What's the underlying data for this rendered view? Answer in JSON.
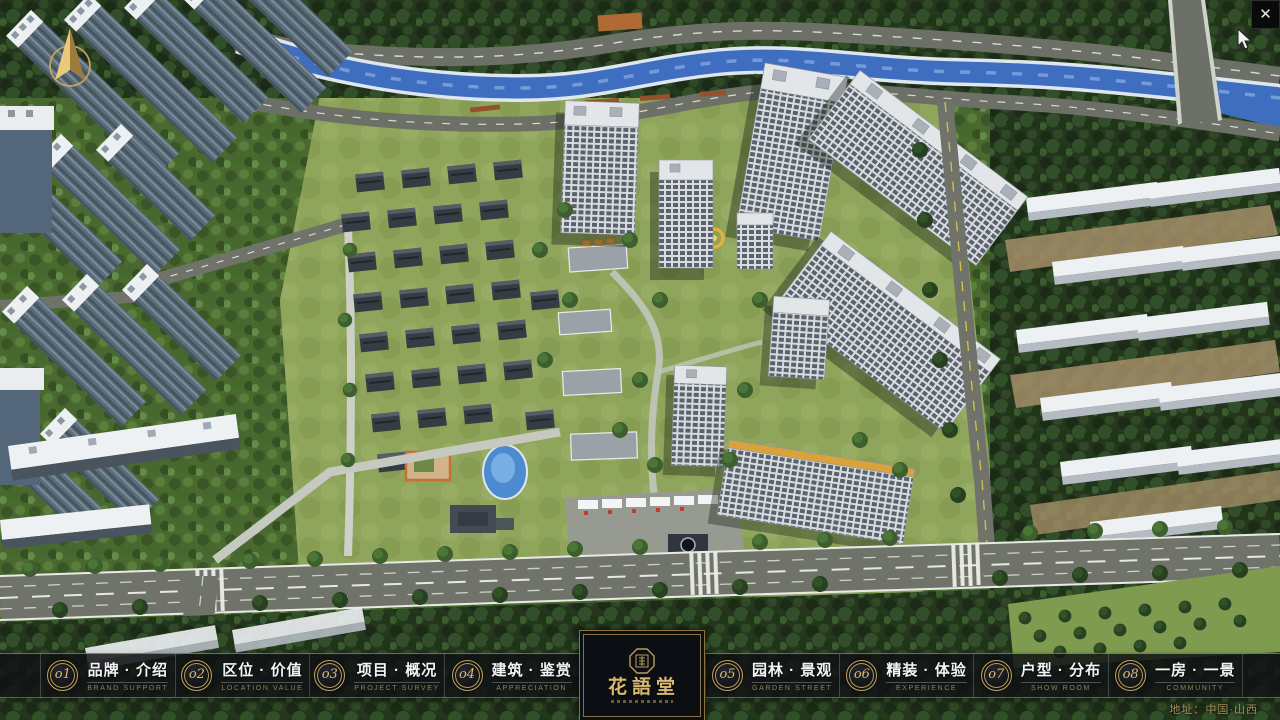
{
  "nav": {
    "items": [
      {
        "num": "o1",
        "label": "品牌 · 介绍",
        "sublabel": "BRAND SUPPORT"
      },
      {
        "num": "o2",
        "label": "区位 · 价值",
        "sublabel": "LOCATION VALUE"
      },
      {
        "num": "o3",
        "label": "项目 · 概况",
        "sublabel": "PROJECT SURVEY"
      },
      {
        "num": "o4",
        "label": "建筑 · 鉴赏",
        "sublabel": "APPRECIATION"
      },
      {
        "num": "o5",
        "label": "园林 · 景观",
        "sublabel": "GARDEN STREET"
      },
      {
        "num": "o6",
        "label": "精装 · 体验",
        "sublabel": "EXPERIENCE"
      },
      {
        "num": "o7",
        "label": "户型 · 分布",
        "sublabel": "SHOW ROOM"
      },
      {
        "num": "o8",
        "label": "一房 · 一景",
        "sublabel": "COMMUNITY"
      }
    ]
  },
  "logo": {
    "title": "花語堂"
  },
  "footer": {
    "address": "地址：中国·山西"
  },
  "window": {
    "close_label": "✕"
  },
  "colors": {
    "gold": "#c9a860",
    "bar_bg": "rgba(15,17,20,0.84)",
    "river": "#3f6ec0",
    "road": "#70736a"
  }
}
